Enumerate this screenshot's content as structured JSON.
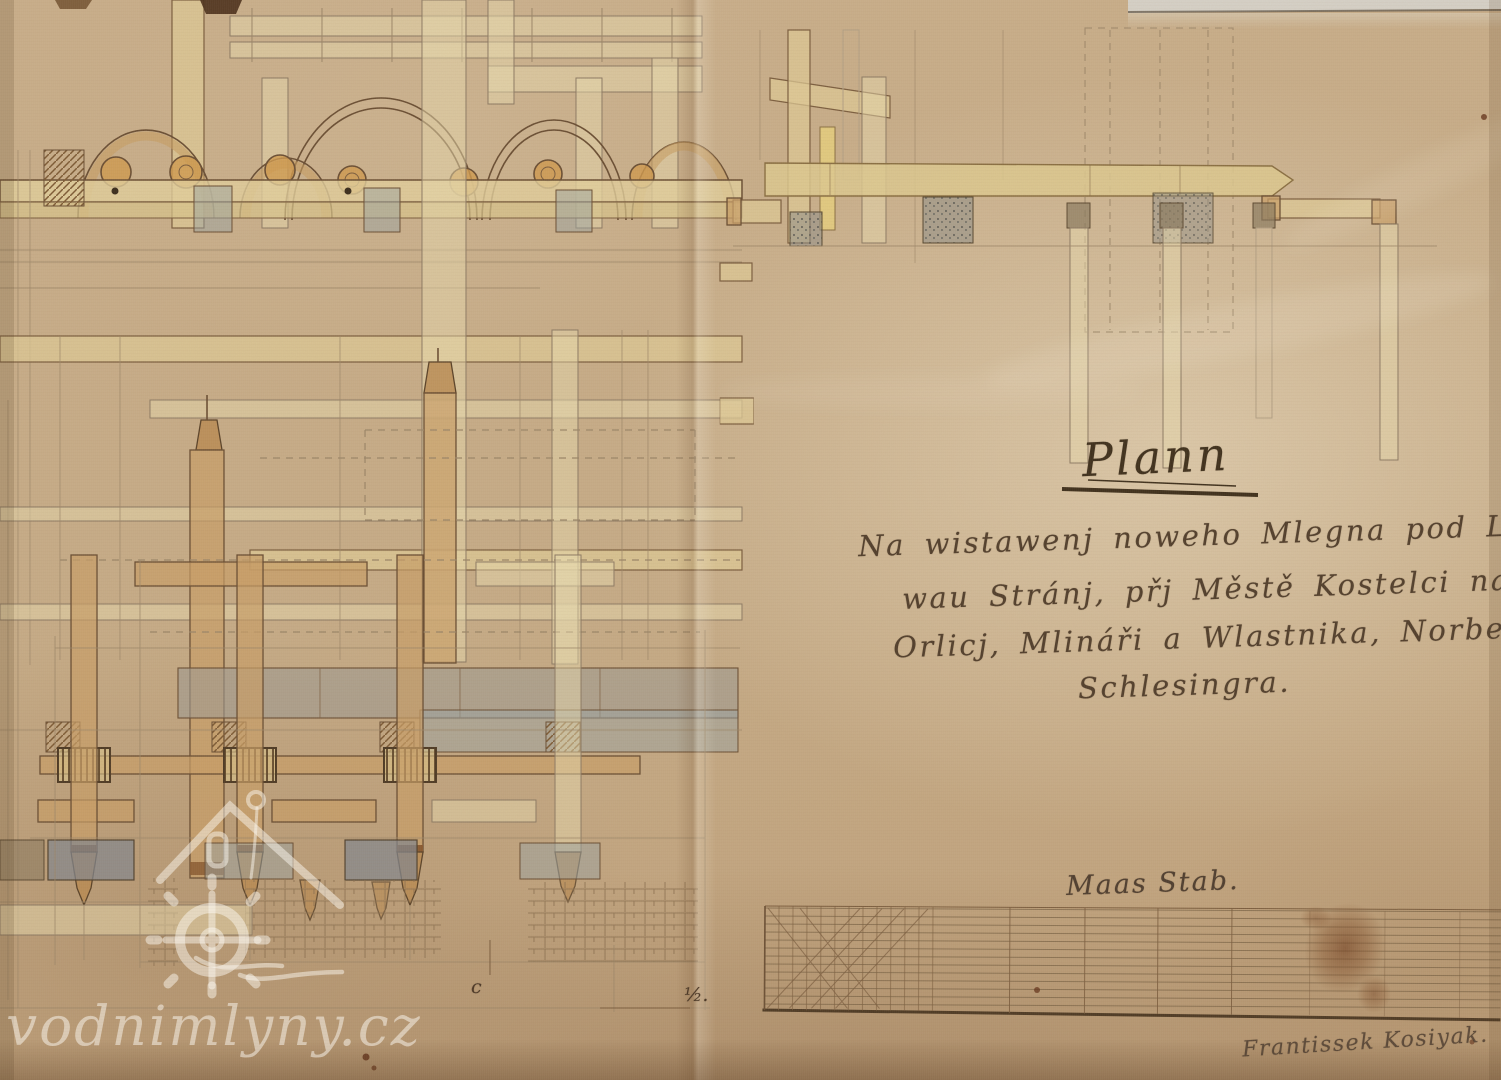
{
  "document": {
    "title": "Plann",
    "body_lines": [
      "Na wistawenj noweho Mlegna pod Lipo,",
      "wau Stránj, přj Městě Kostelci nad",
      "Orlicj, Mlináři a Wlastnika, Norberta",
      "Schlesingra."
    ],
    "scale_label": "Maas Stab.",
    "signature": "Frantissek Kosiyak.",
    "fold_mark": "½.",
    "corner_mark": "c"
  },
  "watermark": {
    "text": "vodnimlyny.cz"
  },
  "colors": {
    "paper": "#c9ae8a",
    "paper_light": "#decbac",
    "paper_dark": "#a98a67",
    "ink": "#6a4e33",
    "pencil": "#9c8668",
    "wash_yellow": "#dfcb96",
    "wash_tan": "#c99e66",
    "wash_orange": "#cf9a4e",
    "stone_gray": "#9f9b92",
    "stone_blue": "#9aa3a4",
    "stain_brown": "#6f3c1d",
    "handwriting_ink": "#4c3a29",
    "watermark_white": "rgba(252,248,240,0.52)"
  }
}
